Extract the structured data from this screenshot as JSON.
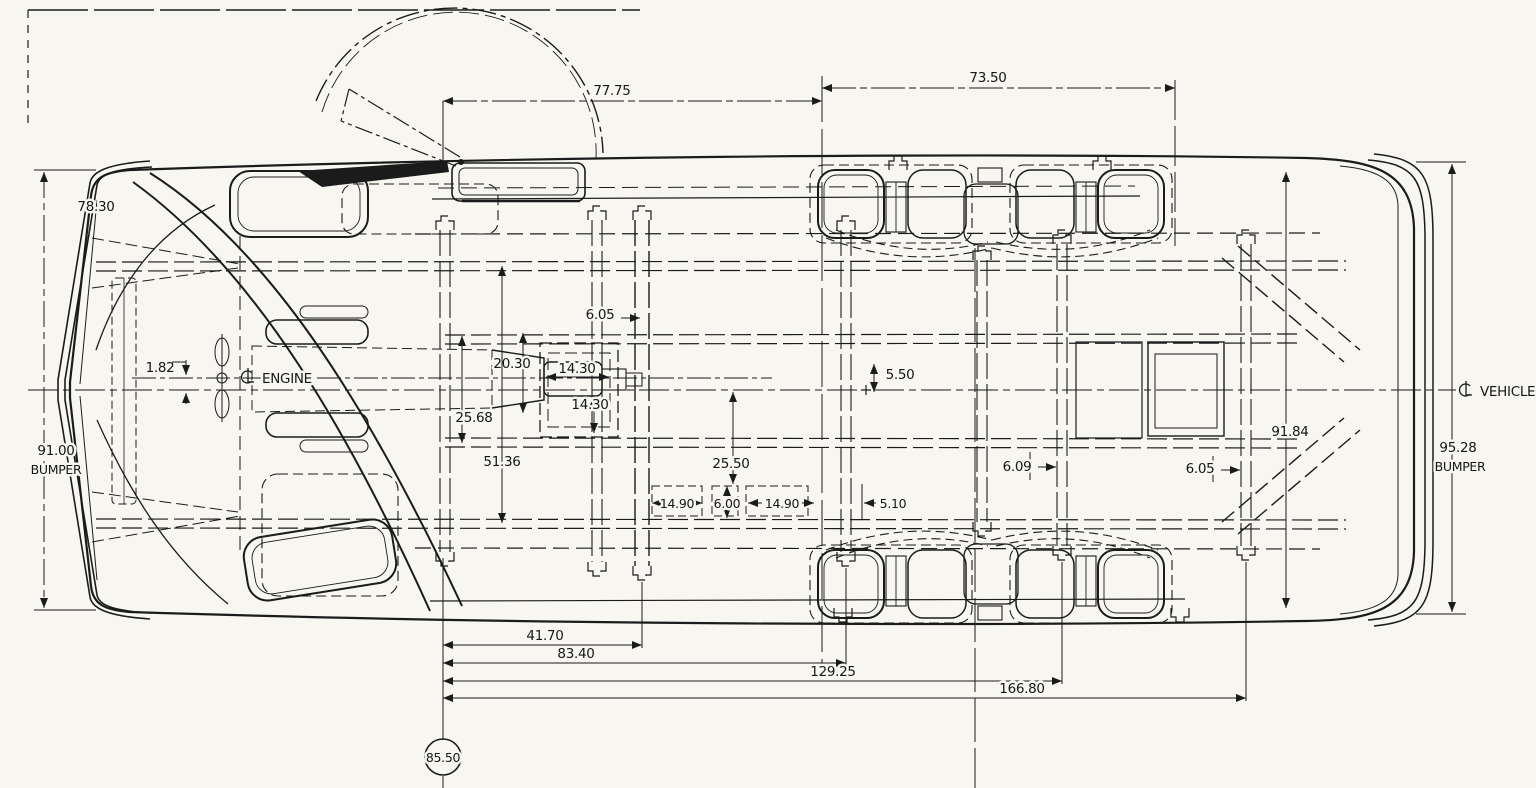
{
  "drawing": {
    "kind": "vehicle chassis plan view engineering drawing",
    "ink_color": "#1b1b1b",
    "paper_color": "#f7f6f1"
  },
  "labels": {
    "engine_centerline": "ENGINE",
    "vehicle_centerline": "VEHICLE",
    "front_bumper_word": "BUMPER",
    "rear_bumper_word": "BUMPER"
  },
  "dimensions": {
    "upper_front_span": "77.75",
    "upper_rear_span": "73.50",
    "body_width": "78.30",
    "front_bumper_width": "91.00",
    "engine_centerline_offset": "1.82",
    "crossmember_offset_front": "6.05",
    "frame_inner_width": "20.30",
    "hump_width": "14.30",
    "hump_length": "14.30",
    "frame_half_span": "25.68",
    "frame_span": "51.36",
    "floor_to_centerline": "25.50",
    "sill_segment_left": "14.90",
    "sill_gap": "6.00",
    "sill_segment_right": "14.90",
    "rail_flange": "5.10",
    "rear_floor_offset": "5.50",
    "crossmember_offset_mid": "6.09",
    "crossmember_offset_rear": "6.05",
    "rear_body_width": "91.84",
    "rear_bumper_width": "95.28",
    "axle_to_crossmember": "41.70",
    "axle_to_mid_frame": "83.40",
    "axle_to_rear_hanger": "129.25",
    "axle_to_frame_end": "166.80",
    "front_axle_station": "85.50"
  }
}
